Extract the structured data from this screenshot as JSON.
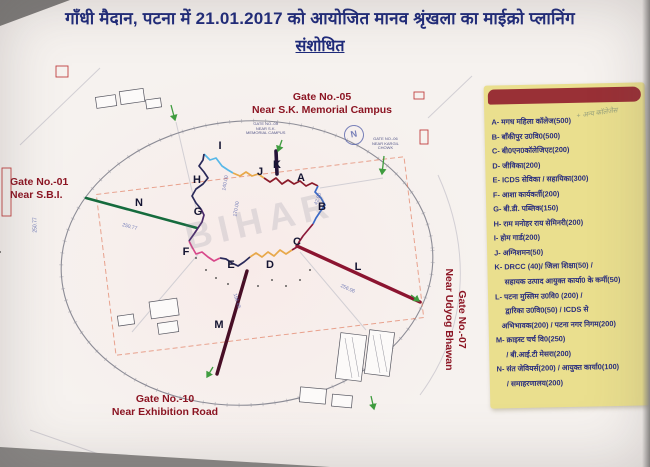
{
  "title": {
    "line1": "गाँधी मैदान, पटना में 21.01.2017 को आयोजित मानव श्रृंखला का माईक्रो प्लानिंग",
    "line2": "संशोधित"
  },
  "gates": {
    "gate05": "Gate No.-05\nNear S.K. Memorial Campus",
    "gate01": "Gate No.-01\nNear S.B.I.",
    "gate10": "Gate No.-10\nNear Exhibition Road",
    "gate07": "Gate No.-07\nNear Udyog Bhawan"
  },
  "legend": {
    "handwritten": "+ अन्य कॉलेजेस",
    "items": [
      {
        "t": "A- मगध महिला कॉलेज(500)",
        "ind": 0
      },
      {
        "t": "B- बाँकीपुर उ0वि0(500)",
        "ind": 0
      },
      {
        "t": "C- बी0एन0कॉलेजिएट(200)",
        "ind": 0
      },
      {
        "t": "D- जीविका(200)",
        "ind": 0
      },
      {
        "t": "E- ICDS सेविका / सहायिका(300)",
        "ind": 0
      },
      {
        "t": "F- आशा कार्यकर्ती(200)",
        "ind": 0
      },
      {
        "t": "G- बी.डी. पब्लिक(150)",
        "ind": 0
      },
      {
        "t": "H- राम मनोहर राय सेमिनरी(200)",
        "ind": 0
      },
      {
        "t": "I- होम गार्ड(200)",
        "ind": 0
      },
      {
        "t": "J- अग्निशमन(50)",
        "ind": 0
      },
      {
        "t": "K- DRCC (40)/ जिला शिक्षा(50) /",
        "ind": 0
      },
      {
        "t": "सहायक उत्पाद आयुक्त कार्या0 के कर्मी(50)",
        "ind": 10
      },
      {
        "t": "L- पटना मुस्लिम उ0वि0 (200) /",
        "ind": 0
      },
      {
        "t": "द्वारिका उ0वि0(50) / ICDS से",
        "ind": 10
      },
      {
        "t": "अभिभावक(200) / पटना नगर निगम(200)",
        "ind": 6
      },
      {
        "t": "M- क्राइस्ट चर्च वि0(250)",
        "ind": 0
      },
      {
        "t": "/ बी.आई.टी मेसरा(200)",
        "ind": 10
      },
      {
        "t": "N- संत जेवियर्स(200) / आयुक्त कार्या0(100)",
        "ind": 0
      },
      {
        "t": "/ समाहरणालय(200)",
        "ind": 10
      }
    ]
  },
  "map": {
    "watermark": "BIHAR",
    "compass": "N",
    "letters": [
      {
        "ch": "A",
        "x": 294,
        "y": 172
      },
      {
        "ch": "B",
        "x": 315,
        "y": 201
      },
      {
        "ch": "C",
        "x": 290,
        "y": 236
      },
      {
        "ch": "D",
        "x": 263,
        "y": 259
      },
      {
        "ch": "E",
        "x": 224,
        "y": 259
      },
      {
        "ch": "F",
        "x": 179,
        "y": 246
      },
      {
        "ch": "G",
        "x": 191,
        "y": 206
      },
      {
        "ch": "H",
        "x": 190,
        "y": 174
      },
      {
        "ch": "I",
        "x": 213,
        "y": 140
      },
      {
        "ch": "J",
        "x": 253,
        "y": 166
      },
      {
        "ch": "K",
        "x": 270,
        "y": 159
      },
      {
        "ch": "L",
        "x": 351,
        "y": 261
      },
      {
        "ch": "M",
        "x": 212,
        "y": 319
      },
      {
        "ch": "N",
        "x": 132,
        "y": 197
      }
    ],
    "dimensions": [
      {
        "t": "250.77",
        "x": 122,
        "y": 224,
        "r": 15
      },
      {
        "t": "256.06",
        "x": 340,
        "y": 286,
        "r": 24
      },
      {
        "t": "196.45",
        "x": 229,
        "y": 298,
        "r": 73
      },
      {
        "t": "140.00",
        "x": 218,
        "y": 180,
        "r": -80
      },
      {
        "t": "170.00",
        "x": 229,
        "y": 206,
        "r": -80
      },
      {
        "t": "42.00",
        "x": 312,
        "y": 196,
        "r": -70
      },
      {
        "t": "250.77",
        "x": 28,
        "y": 222,
        "r": -90
      }
    ],
    "tiny_labels": [
      {
        "t": "GATE NO.-05\nNEAR S.K.\nMEMORIAL CAMPUS",
        "x": 246,
        "y": 122
      },
      {
        "t": "GATE NO.-06\nNEAR KARGIL\nCHOWK",
        "x": 372,
        "y": 137
      }
    ]
  },
  "colors": {
    "legend_bg": "#eadf8e",
    "legend_header": "#993036",
    "text_navy": "#2b2f7d",
    "gate_maroon": "#8c1523",
    "line_green": "#156b3d",
    "line_maroon": "#8b1430",
    "line_dark": "#480e26",
    "seg_I": "#58b8e8",
    "seg_J": "#e8a84a",
    "seg_A": "#8b1a2a",
    "seg_B": "#3a6ac8",
    "seg_C": "#8b1a3a",
    "seg_D": "#e8a84a",
    "seg_E": "#2a2a5a",
    "seg_F": "#d8488a",
    "seg_G": "#4a2a6a",
    "seg_H": "#2a2a5a",
    "seg_K": "#251338"
  }
}
